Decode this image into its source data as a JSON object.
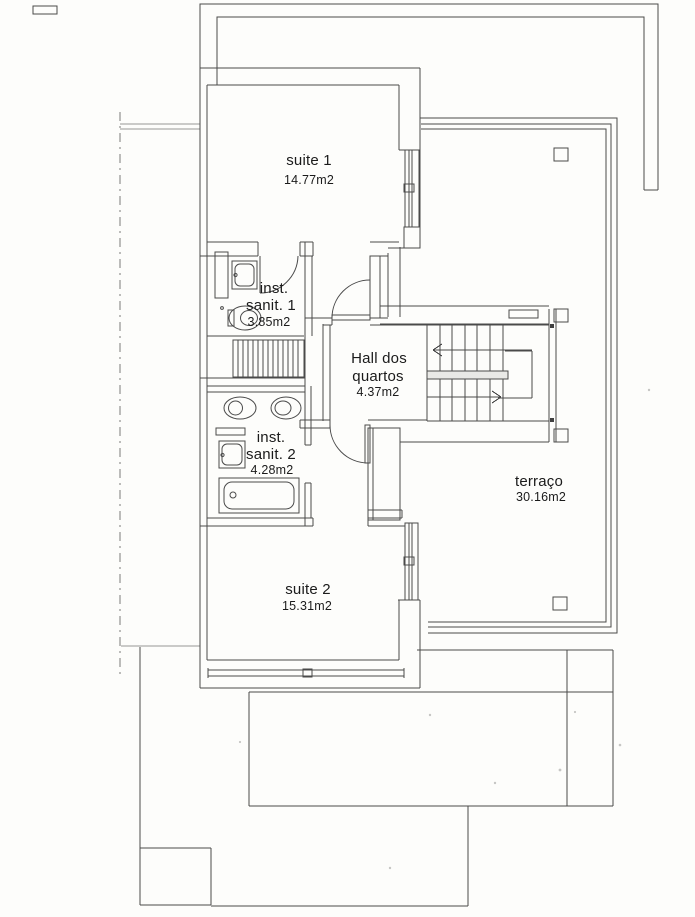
{
  "plan": {
    "rooms": {
      "suite1": {
        "name": "suite 1",
        "area": "14.77m2"
      },
      "sanit1": {
        "line1": "inst.",
        "line2": "sanit. 1",
        "area": "3.85m2"
      },
      "hall": {
        "line1": "Hall dos",
        "line2": "quartos",
        "area": "4.37m2"
      },
      "sanit2": {
        "line1": "inst.",
        "line2": "sanit. 2",
        "area": "4.28m2"
      },
      "suite2": {
        "name": "suite 2",
        "area": "15.31m2"
      },
      "terraco": {
        "name": "terraço",
        "area": "30.16m2"
      }
    },
    "fixtures": {
      "bath1": [
        "washbasin",
        "toilet",
        "shower"
      ],
      "bath2": [
        "bidet",
        "toilet",
        "washbasin",
        "bathtub"
      ],
      "circulation": [
        "staircase",
        "door-arcs"
      ]
    },
    "colors": {
      "paper": "#fdfdfb",
      "wall": "#4a4a4a",
      "light": "#979794",
      "fixture": "#6f6f6f",
      "text": "#1b1b1b"
    }
  }
}
